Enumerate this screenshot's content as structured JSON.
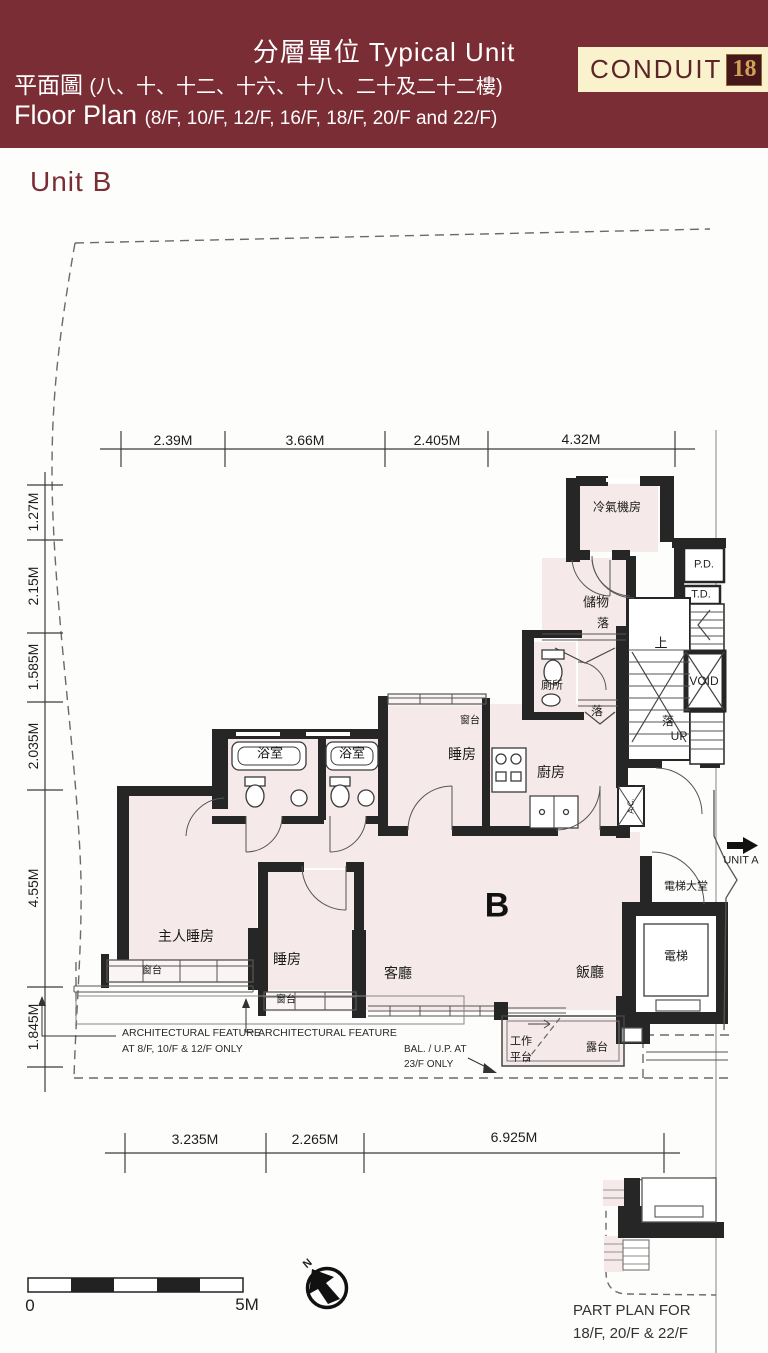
{
  "header": {
    "title": "分層單位 Typical Unit",
    "subtitle_zh": "平面圖",
    "subtitle_zh_suffix": "(八、十、十二、十六、十八、二十及二十二樓)",
    "subtitle_en": "Floor Plan",
    "subtitle_en_suffix": "(8/F, 10/F, 12/F, 16/F, 18/F, 20/F and 22/F)",
    "logo": {
      "name": "CONDUIT",
      "number": "18"
    }
  },
  "unit_title": "Unit B",
  "dims": {
    "top": [
      "2.39M",
      "3.66M",
      "2.405M",
      "4.32M"
    ],
    "left": [
      "1.27M",
      "2.15M",
      "1.585M",
      "2.035M",
      "4.55M",
      "1.845M"
    ],
    "bottom": [
      "3.235M",
      "2.265M",
      "6.925M"
    ]
  },
  "rooms": {
    "ac_plant": "冷氣機房",
    "pd": "P.D.",
    "td": "T.D.",
    "store": "儲物",
    "drop_store": "落",
    "toilet": "廁所",
    "up_stair": "上",
    "void": "VOID",
    "drop_corridor": "落",
    "drop_stair": "落",
    "up_label": "UP",
    "bath1": "浴室",
    "bath2": "浴室",
    "bedroom_mid": "睡房",
    "bay_mid": "窗台",
    "kitchen": "廚房",
    "master": "主人睡房",
    "bay_master": "窗台",
    "bedroom2": "睡房",
    "bay_bed2": "窗台",
    "living": "客廳",
    "dining": "飯廳",
    "unit_label": "B",
    "lobby": "電梯大堂",
    "lift": "電梯",
    "ac_unit": "A.C.",
    "utility_l1": "工作",
    "utility_l2": "平台",
    "balcony": "露台"
  },
  "annotations": {
    "unit_a": "UNIT A",
    "arch1_l1": "ARCHITECTURAL FEATURE",
    "arch1_l2": "AT 8/F, 10/F & 12/F ONLY",
    "arch2": "ARCHITECTURAL FEATURE",
    "bal_l1": "BAL. / U.P. AT",
    "bal_l2": "23/F ONLY"
  },
  "scale_bar": {
    "zero": "0",
    "five": "5M"
  },
  "compass": {
    "north": "N"
  },
  "part_plan": {
    "l1": "PART PLAN FOR",
    "l2": "18/F, 20/F & 22/F"
  },
  "colors": {
    "header_bg": "#7a2d34",
    "logo_bg": "#f9f2cc",
    "accent_maroon": "#7a2d34",
    "floor_pink": "#f6e9e9",
    "wall_black": "#262626"
  }
}
